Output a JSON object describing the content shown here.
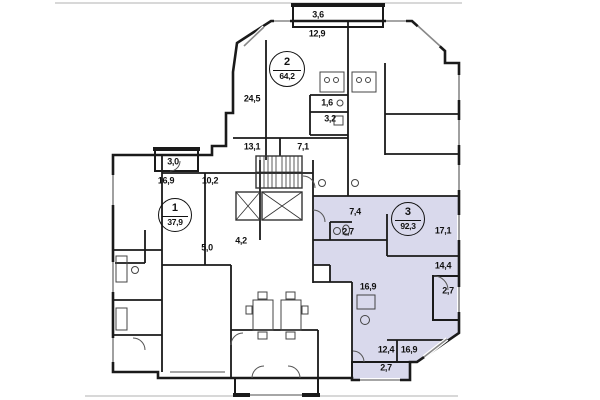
{
  "floorplan": {
    "type": "apartment-floor-plan",
    "apartments": [
      {
        "number": "1",
        "area": "37,9"
      },
      {
        "number": "2",
        "area": "64,2"
      },
      {
        "number": "3",
        "area": "92,3"
      }
    ],
    "rooms": [
      {
        "name": "balcony-top",
        "text": "3,6"
      },
      {
        "name": "room-12-9",
        "text": "12,9"
      },
      {
        "name": "room-24-5",
        "text": "24,5"
      },
      {
        "name": "room-1-6",
        "text": "1,6"
      },
      {
        "name": "room-3-2",
        "text": "3,2"
      },
      {
        "name": "room-13-1",
        "text": "13,1"
      },
      {
        "name": "room-7-1",
        "text": "7,1"
      },
      {
        "name": "balcony-left",
        "text": "3,0"
      },
      {
        "name": "room-16-9-apt1",
        "text": "16,9"
      },
      {
        "name": "room-10-2",
        "text": "10,2"
      },
      {
        "name": "hall-5-0",
        "text": "5,0"
      },
      {
        "name": "room-4-2",
        "text": "4,2"
      },
      {
        "name": "hall-7-4",
        "text": "7,4"
      },
      {
        "name": "wc-2-7",
        "text": "2,7"
      },
      {
        "name": "room-17-1",
        "text": "17,1"
      },
      {
        "name": "room-14-4",
        "text": "14,4"
      },
      {
        "name": "loggia-right-2-7",
        "text": "2,7"
      },
      {
        "name": "kitchen-16-9",
        "text": "16,9"
      },
      {
        "name": "room-12-4",
        "text": "12,4"
      },
      {
        "name": "room-16-9-bottom",
        "text": "16,9"
      },
      {
        "name": "loggia-bottom-2-7",
        "text": "2,7"
      }
    ],
    "colors": {
      "highlight": "#d9d9ec",
      "wall": "#1a1a1a",
      "fixture": "#444444",
      "sheet_line": "#b0b0b0"
    }
  }
}
